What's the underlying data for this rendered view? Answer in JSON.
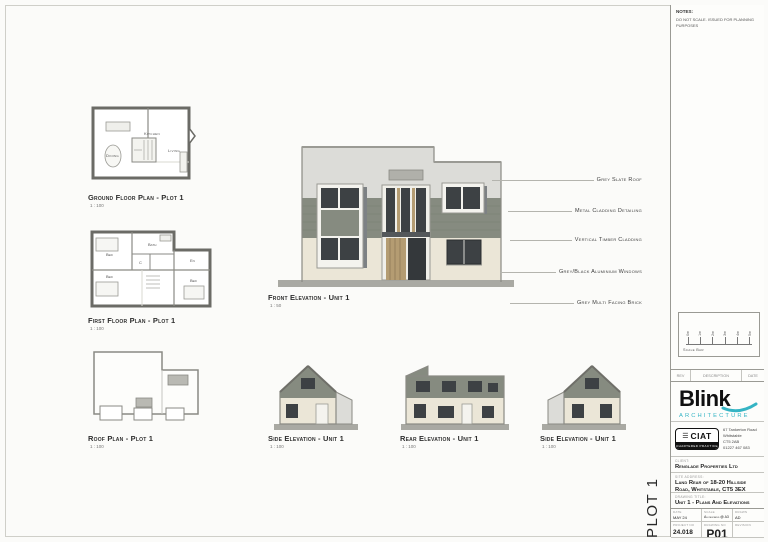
{
  "notes": {
    "title": "NOTES:",
    "body": "DO NOT SCALE. ISSUED FOR PLANNING PURPOSES"
  },
  "views": {
    "ground_floor": {
      "title": "Ground Floor Plan - Plot 1",
      "scale": "1 : 100",
      "rooms": {
        "kitchen": "Kitchen",
        "living": "Living",
        "dining": "Dining"
      }
    },
    "first_floor": {
      "title": "First Floor Plan - Plot 1",
      "scale": "1 : 100",
      "rooms": {
        "bed1": "Bed",
        "bath": "Bath",
        "cupboard": "C",
        "ensuite": "En",
        "bed2": "Bed",
        "bed3": "Bed"
      }
    },
    "roof": {
      "title": "Roof Plan - Plot 1",
      "scale": "1 : 100"
    },
    "front_elevation": {
      "title": "Front Elevation - Unit 1",
      "scale": "1 : 50"
    },
    "side_elevation_left": {
      "title": "Side Elevation - Unit 1",
      "scale": "1 : 100"
    },
    "rear_elevation": {
      "title": "Rear Elevation - Unit 1",
      "scale": "1 : 100"
    },
    "side_elevation_right": {
      "title": "Side Elevation - Unit 1",
      "scale": "1 : 100"
    }
  },
  "annotations": [
    {
      "label": "Grey Slate Roof"
    },
    {
      "label": "Metal Cladding Detailing"
    },
    {
      "label": "Vertical Timber Cladding"
    },
    {
      "label": "Grey/Black Aluminium Windows"
    },
    {
      "label": "Grey Multi Facing Brick"
    }
  ],
  "plot_label": "PLOT 1",
  "scale_bar": {
    "caption": "Scale Bar",
    "ticks": [
      "0m",
      "1m",
      "2m",
      "3m",
      "4m",
      "5m"
    ]
  },
  "revision_header": {
    "rev": "REV",
    "description": "DESCRIPTION",
    "date": "DATE"
  },
  "title_block": {
    "logo": {
      "name": "Blink",
      "sub": "ARCHITECTURE",
      "accent_color": "#35b4c4"
    },
    "ciat": {
      "name": "CIAT",
      "badge": "CHARTERED PRACTICE",
      "address_lines": [
        "67 Tankerton Road",
        "Whitstable",
        "CT5 2AB",
        "01227 467 083"
      ]
    },
    "client": {
      "label": "CLIENT:",
      "value": "Renglade Properties Ltd"
    },
    "site": {
      "label": "SITE ADDRESS:",
      "value": "Land Rear of 18-20 Hillside Road, Whitstable, CT5 3EX"
    },
    "drawing": {
      "label": "DRAWING TITLE:",
      "value": "Unit 1 - Plans And Elevations"
    },
    "fields": [
      {
        "label": "DATE",
        "value": "MAY 24"
      },
      {
        "label": "SCALE",
        "value": "As indicated @ A3"
      },
      {
        "label": "DRAWN",
        "value": "AD"
      },
      {
        "label": "PROJECT NO",
        "value": "24.018"
      },
      {
        "label": "DRAWING NO",
        "value": "P01"
      },
      {
        "label": "REVISION",
        "value": ""
      }
    ]
  },
  "colors": {
    "cladding": "#868b80",
    "brick": "#ebe6d7",
    "parapet": "#dcdcd8",
    "window": "#3d4144",
    "timber": "#b49c72",
    "ground": "#a9a9a3",
    "accent": "#35b4c4"
  }
}
